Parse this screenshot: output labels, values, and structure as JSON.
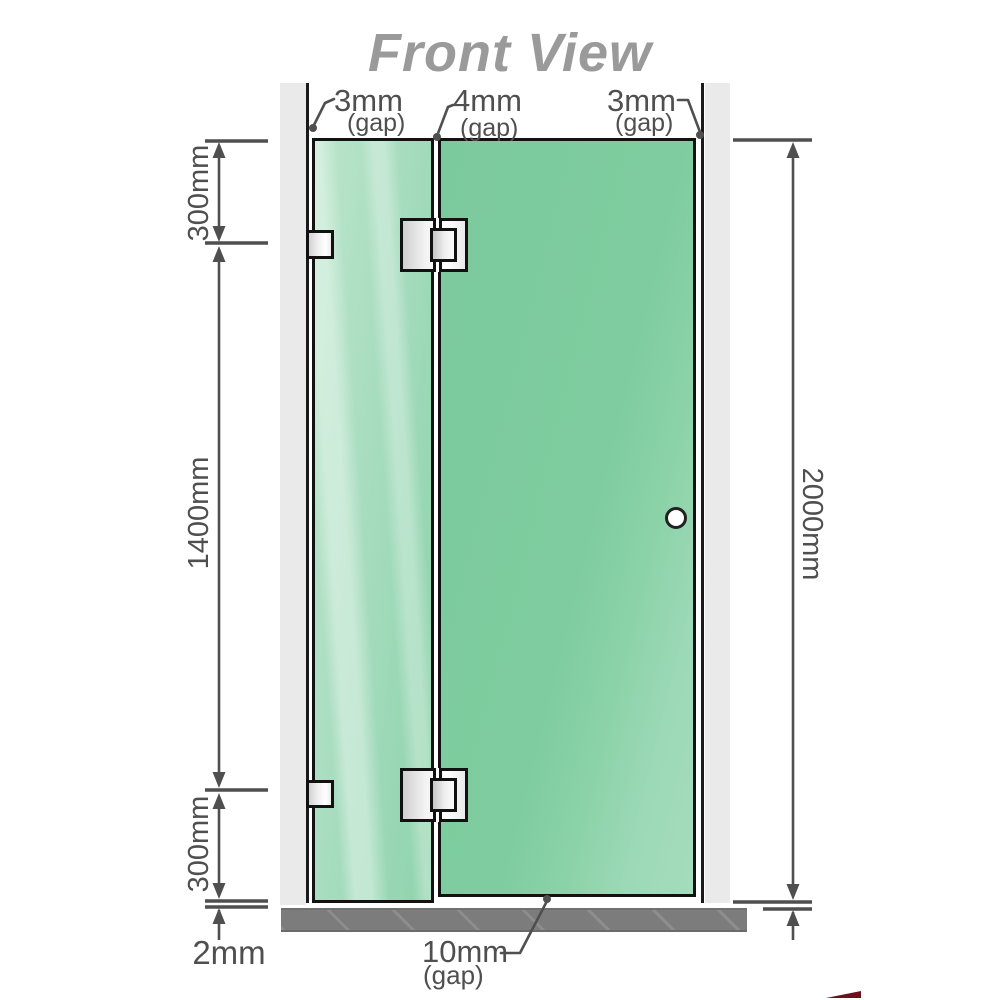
{
  "title": "Front View",
  "gaps": {
    "top_left": {
      "value": "3mm",
      "label": "(gap)"
    },
    "top_middle": {
      "value": "4mm",
      "label": "(gap)"
    },
    "top_right": {
      "value": "3mm",
      "label": "(gap)"
    },
    "bottom": {
      "value": "10mm",
      "label": "(gap)"
    }
  },
  "dimensions": {
    "left_top": "300mm",
    "left_middle": "1400mm",
    "left_bottom": "300mm",
    "right_total": "2000mm",
    "floor_gap": "2mm"
  },
  "icons": {
    "handle": "door-handle-knob",
    "hinges": "glass-to-glass-hinge",
    "brackets": "wall-to-glass-bracket"
  },
  "colors": {
    "glass_fixed_panel": "#a9ddc0",
    "glass_door_panel": "#7ecc9f",
    "wall": "#eaeaea",
    "floor": "#7c7c7c",
    "dimension_lines": "#4f4f4f",
    "title_text": "#9a9a9a",
    "hinge_fill": "#f2f2f2",
    "corner_watermark": "#6f0f1d"
  }
}
